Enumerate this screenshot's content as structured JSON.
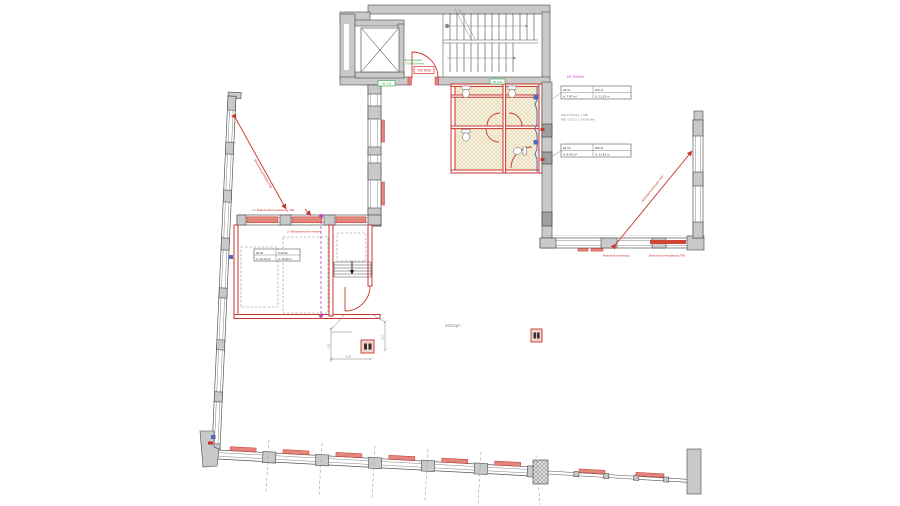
{
  "drawing": {
    "area_label": "202sqm",
    "stair_door": {
      "tag": "T30 RSS",
      "note_line1": "Brandschutztür",
      "note_line2": "T30-RS Element"
    },
    "wc": {
      "green_note": "UK 2.10",
      "hz_note": "HZ 100mm",
      "wall_note_line1": "Wand: Stärke n. MB",
      "wall_note_line2": "MB: 17/11,5 ü. OK Boden",
      "tags": [
        {
          "no": "02.11",
          "name": "WC-H",
          "area": "A: 7.87 m²",
          "perimeter": "U: 11.25 m"
        },
        {
          "no": "02.12",
          "name": "WC-D",
          "area": "A: 8.04 m²",
          "perimeter": "U: 11.52 m"
        }
      ]
    },
    "mid_wall_green_note": "UK 2.26",
    "room_tag": {
      "no": "02.01",
      "name": "Technik",
      "area": "A: 22.10 m²",
      "perimeter": "U: 19.20 m"
    },
    "fire_labels": {
      "glazing_top": "2 x Brandschutzverglasung F90",
      "bestand": "2 x Bestandsfenster erhalten",
      "diag_left": "Brandschutzfenster F90",
      "diag_right": "Brandschutzfenster F90",
      "curtain": "Brandschutzvorhang",
      "glazing_right": "Brandschutzverglasung F90"
    },
    "dims": {
      "d1": "1.32",
      "d2": "1.65",
      "d3": "2.07"
    },
    "colors": {
      "red": "#c9342c",
      "green": "#2e9e3a",
      "magenta": "#bb44bb",
      "blue": "#5566bb",
      "wall_gray": "#c9c9c9",
      "line_dark": "#444444",
      "tan_floor": "#efe8d2"
    }
  }
}
